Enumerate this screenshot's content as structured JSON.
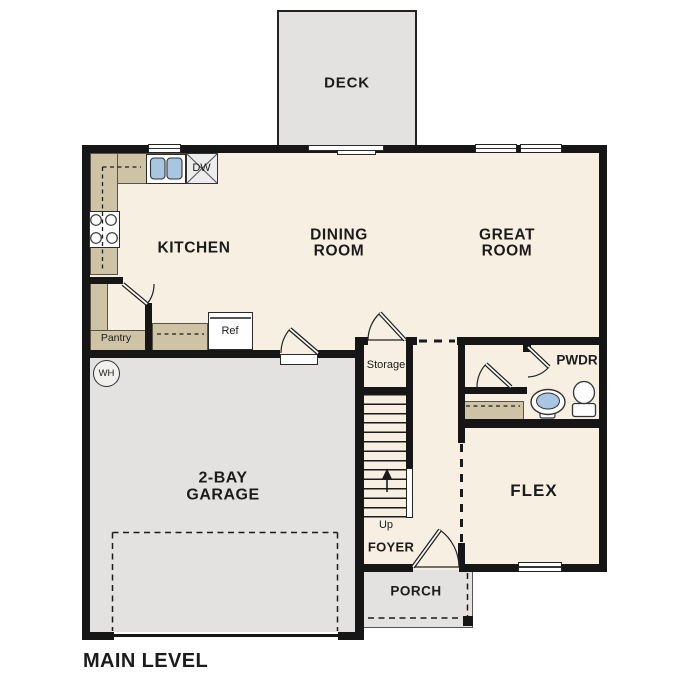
{
  "plan_title": "MAIN LEVEL",
  "rooms": {
    "deck": "DECK",
    "kitchen": "KITCHEN",
    "dining_line1": "DINING",
    "dining_line2": "ROOM",
    "great_line1": "GREAT",
    "great_line2": "ROOM",
    "garage_line1": "2-BAY",
    "garage_line2": "GARAGE",
    "flex": "FLEX",
    "foyer": "FOYER",
    "porch": "PORCH",
    "pwdr": "PWDR",
    "storage": "Storage",
    "pantry": "Pantry"
  },
  "fixtures": {
    "refrigerator": "Ref",
    "dishwasher": "DW",
    "water_heater": "WH",
    "stairs_direction": "Up"
  },
  "colors": {
    "floor": "#f7efe2",
    "counter": "#cfc3a6",
    "exterior": "#e4e2e0",
    "wall": "#161616",
    "sink": "#a8c6e2"
  }
}
